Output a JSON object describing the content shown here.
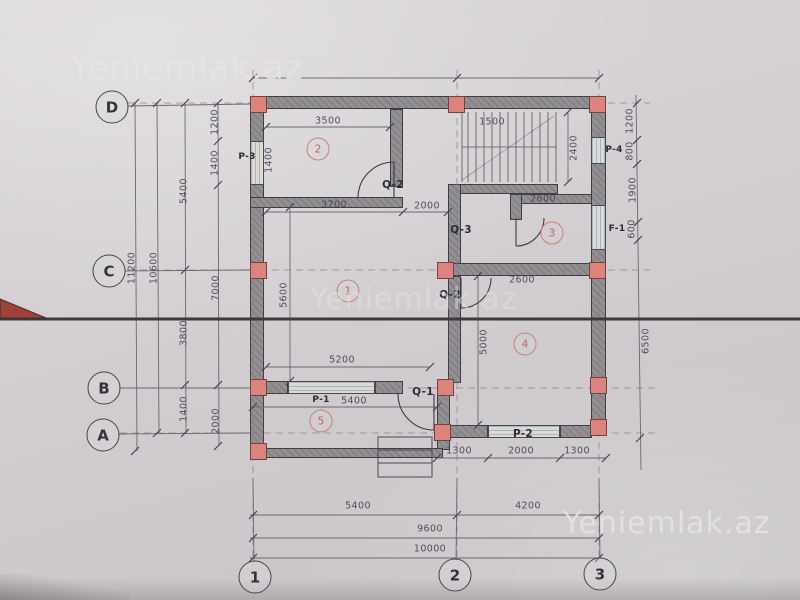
{
  "watermarks": {
    "top_left": "Yeniemlak.az",
    "center": "Yeniemlak.az",
    "bottom_right": "Yeniemlak.az"
  },
  "grid": {
    "row_d": "D",
    "row_c": "C",
    "row_b": "B",
    "row_a": "A",
    "col_1": "1",
    "col_2": "2",
    "col_3": "3"
  },
  "rooms": {
    "r1": "1",
    "r2": "2",
    "r3": "3",
    "r4": "4",
    "r5": "5"
  },
  "openings": {
    "p1": "P-1",
    "p2": "P-2",
    "p3": "P-3",
    "p4": "P-4",
    "f1": "F-1",
    "q1": "Q-1",
    "q2_upper": "Q-2",
    "q2_lower": "Q-2",
    "q3": "Q-3"
  },
  "dims": {
    "room2_width": "3500",
    "stairs_width": "1500",
    "stairs_depth": "2400",
    "hall_width": "3700",
    "hall_depth": "2000",
    "stair_hall": "2600",
    "room3_width": "2600",
    "room1_width": "5200",
    "room1_height": "5600",
    "porch_window": "5400",
    "room4_height": "5000",
    "room4_b1": "1300",
    "room4_b2": "2000",
    "room4_b3": "1300",
    "span_12": "5400",
    "span_23": "4200",
    "span_inner": "9600",
    "span_total": "10000",
    "left_1200": "1200",
    "left_1400a": "1400",
    "left_win": "1400",
    "left_5400": "5400",
    "left_10600": "10600",
    "left_11200": "11200",
    "left_7000": "7000",
    "left_3800": "3800",
    "left_1400b": "1400",
    "left_2000": "2000",
    "right_1200": "1200",
    "right_800": "800",
    "right_1900": "1900",
    "right_600": "600",
    "right_6500": "6500"
  }
}
